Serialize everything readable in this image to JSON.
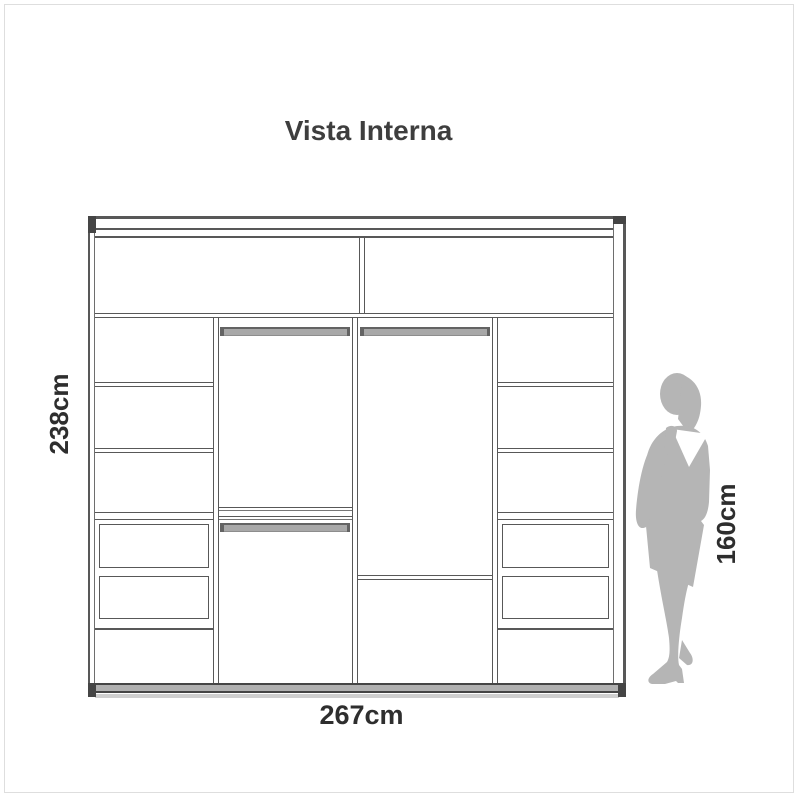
{
  "title": "Vista Interna",
  "wardrobe": {
    "height_label": "238cm",
    "width_label": "267cm",
    "person_height_label": "160cm",
    "person_icon": "woman-silhouette",
    "structure": {
      "top_compartments": 2,
      "columns": [
        {
          "position": "left",
          "shelves": 3,
          "drawers": 2,
          "open_compartments": 1
        },
        {
          "position": "center-left",
          "hanging_rods": 2,
          "shelves": 2
        },
        {
          "position": "center-right",
          "hanging_rods": 1,
          "shelves": 1
        },
        {
          "position": "right",
          "shelves": 3,
          "drawers": 2,
          "open_compartments": 1
        }
      ]
    }
  },
  "colors": {
    "background": "#ffffff",
    "frame_border": "#dedede",
    "line": "#585858",
    "dark": "#454545",
    "rod": "#a8a8a8",
    "rod_edge": "#636363",
    "base": "#b0b0b0",
    "base_light": "#cfcfcf",
    "silhouette": "#b5b5b5",
    "text": "#3e3e3e",
    "label": "#2e2e2e"
  }
}
